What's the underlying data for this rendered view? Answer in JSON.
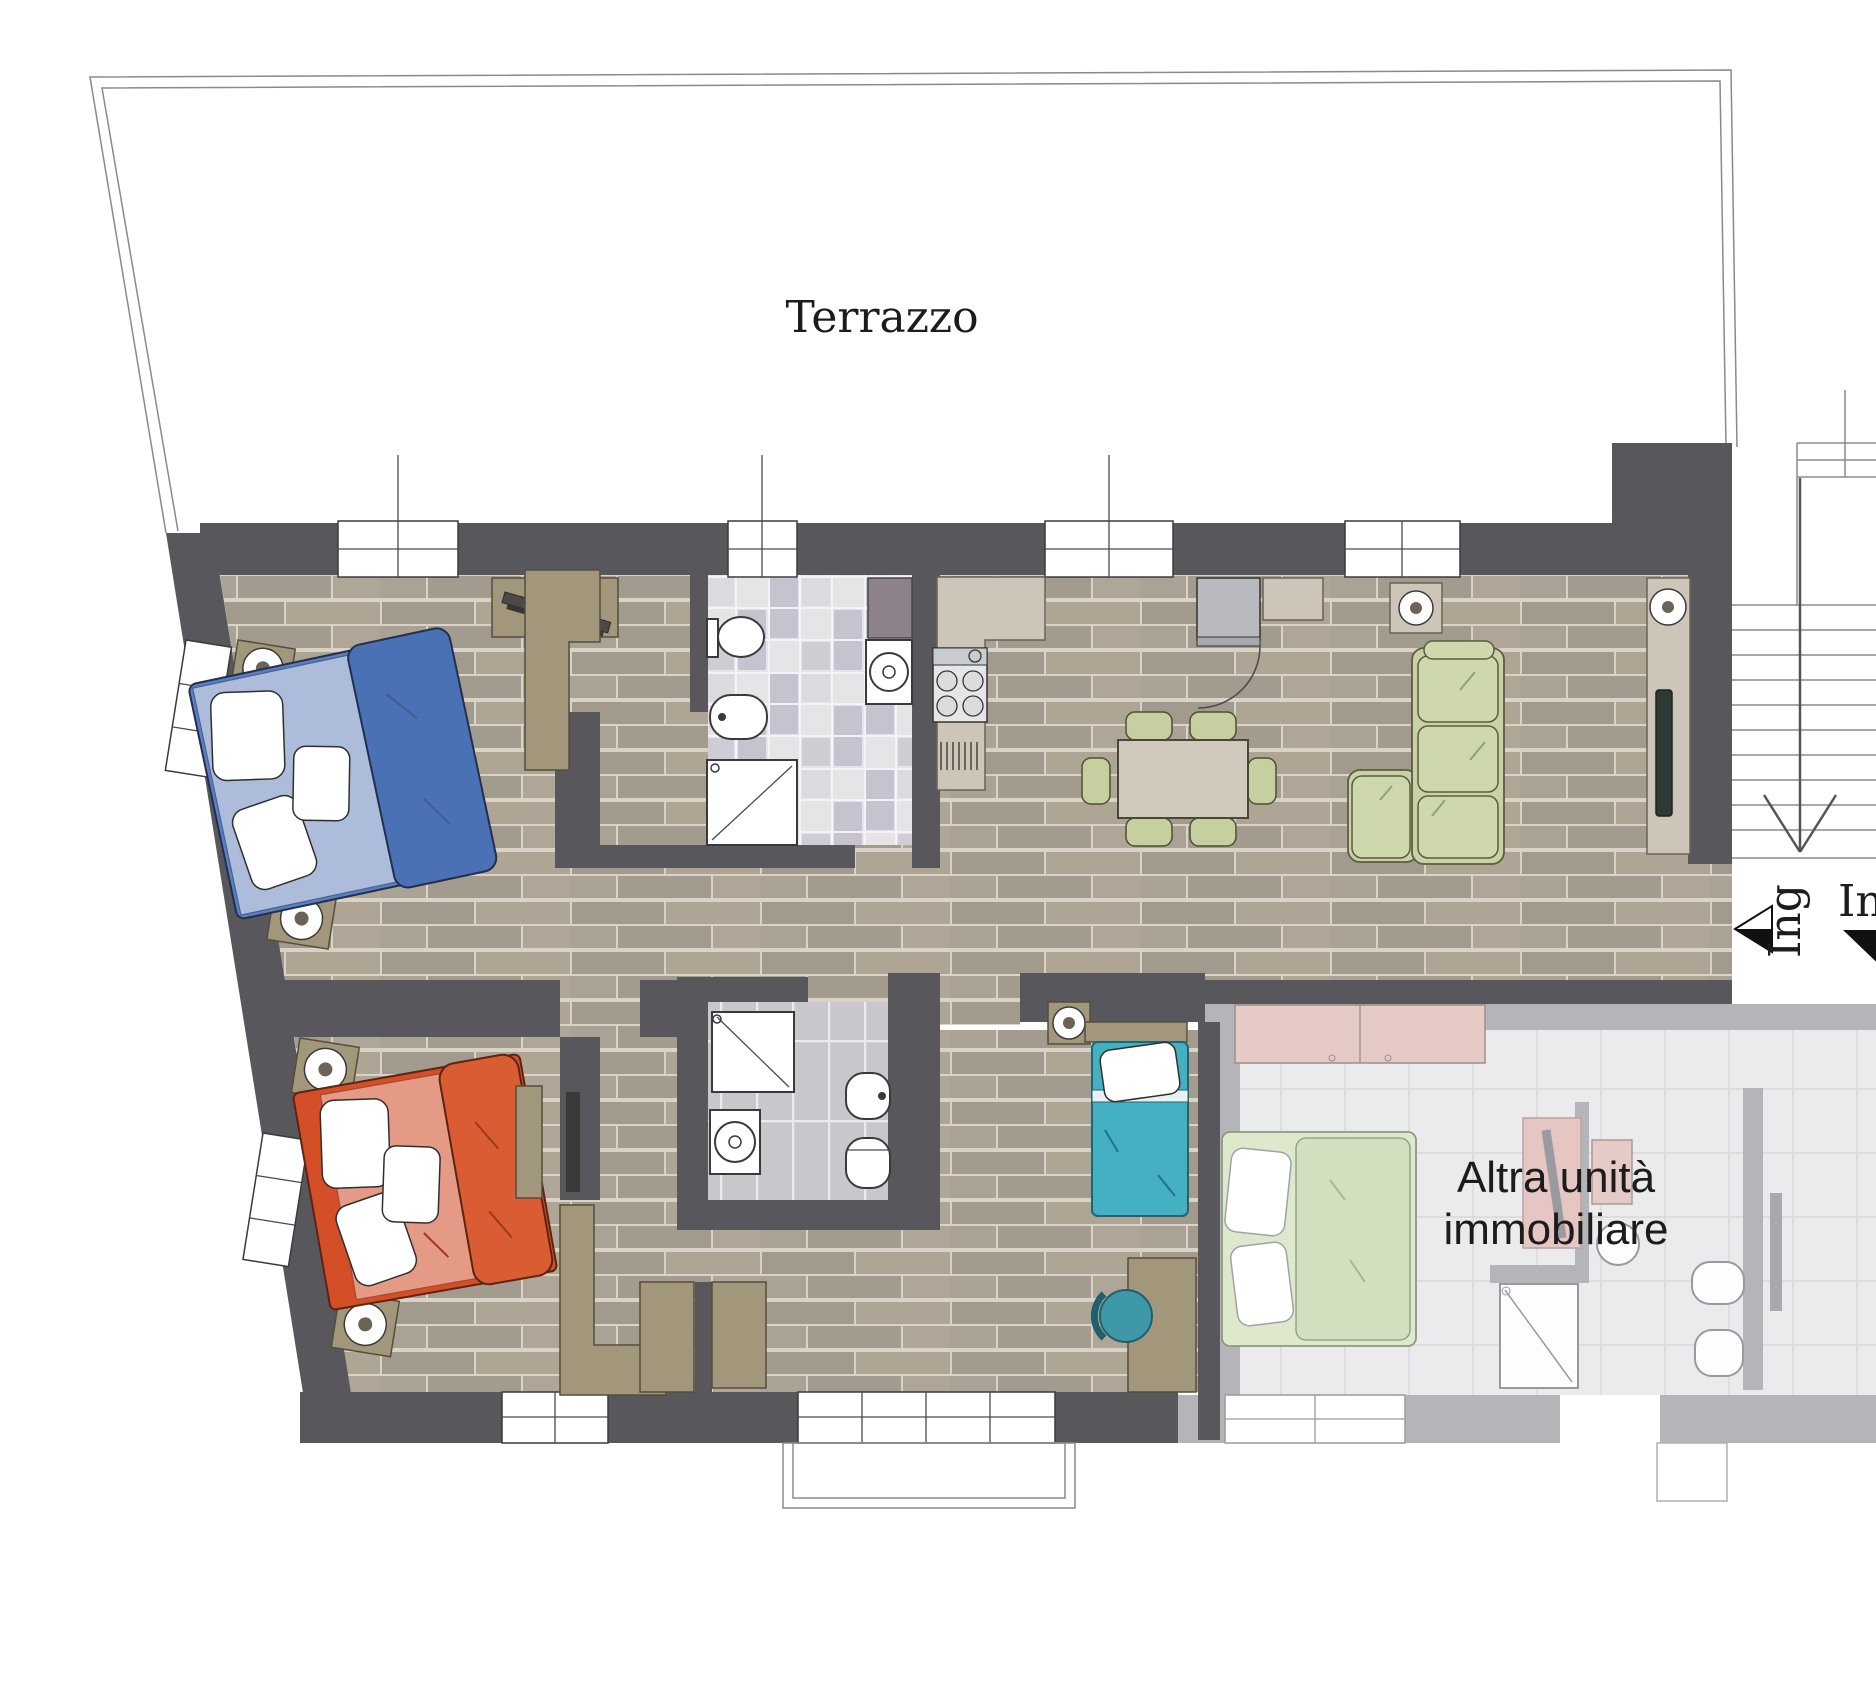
{
  "labels": {
    "terrace": "Terrazzo",
    "other_unit_line1": "Altra unità",
    "other_unit_line2": "immobiliare",
    "entrance_left": "Ing",
    "entrance_right": "In"
  },
  "colors": {
    "wall_dark": "#58585c",
    "wall_light": "#b5b4b9",
    "floor_wood": "#a89f93",
    "bed_blue": "#5b7fc0",
    "bed_blue_sheet": "#adbcda",
    "bed_red": "#d44f27",
    "bed_red_blanket": "#e59a86",
    "bed_teal": "#45b0c2",
    "sofa_green": "#c8d2a4",
    "chair_green": "#c5cfa0",
    "furniture_tan": "#a2977b",
    "counter_beige": "#cdc5b8",
    "unit_pink": "#e6cac5",
    "unit_green": "#dde8cd",
    "text": "#1c1c1c"
  }
}
